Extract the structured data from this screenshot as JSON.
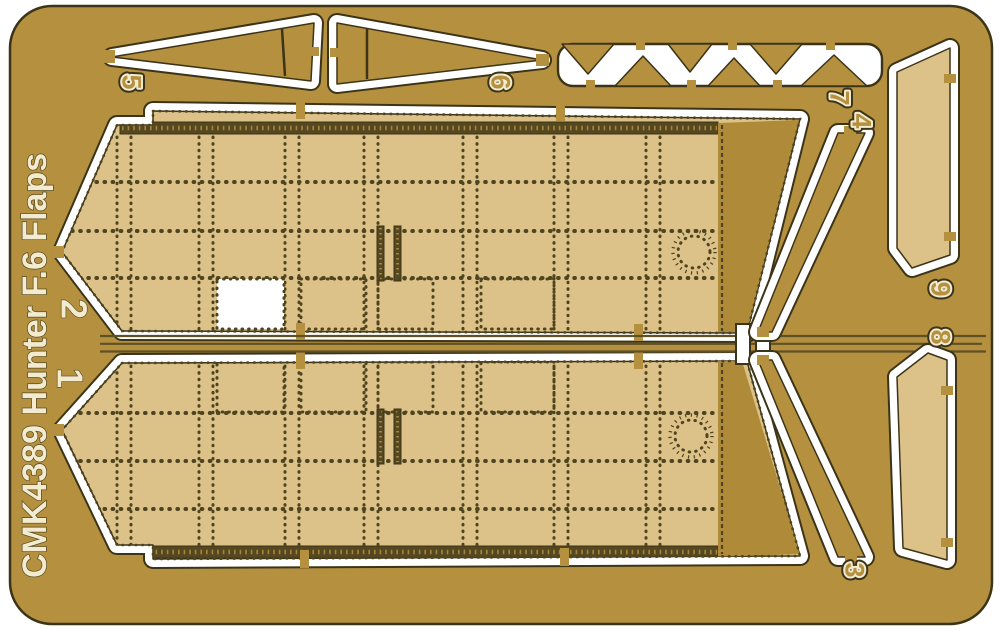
{
  "product": {
    "title": "CMK4389 Hunter F.6 Flaps",
    "description": "photo-etched brass fret with numbered flap parts"
  },
  "part_labels": {
    "p1": "1",
    "p2": "2",
    "p3": "3",
    "p4": "4",
    "p5": "5",
    "p6": "6",
    "p7": "7",
    "p8": "8",
    "p9": "9"
  },
  "colors": {
    "page": "#ffffff",
    "sheet": "#b4903f",
    "sheet_dark": "#af8b39",
    "panel": "#dcc288",
    "cut": "#ffffff",
    "edge": "#3c3418",
    "etch": "#4f4420",
    "strip": "#554820",
    "cream": "#f2ebcf",
    "label_stroke": "#55481f",
    "rail": "#5e5126"
  }
}
